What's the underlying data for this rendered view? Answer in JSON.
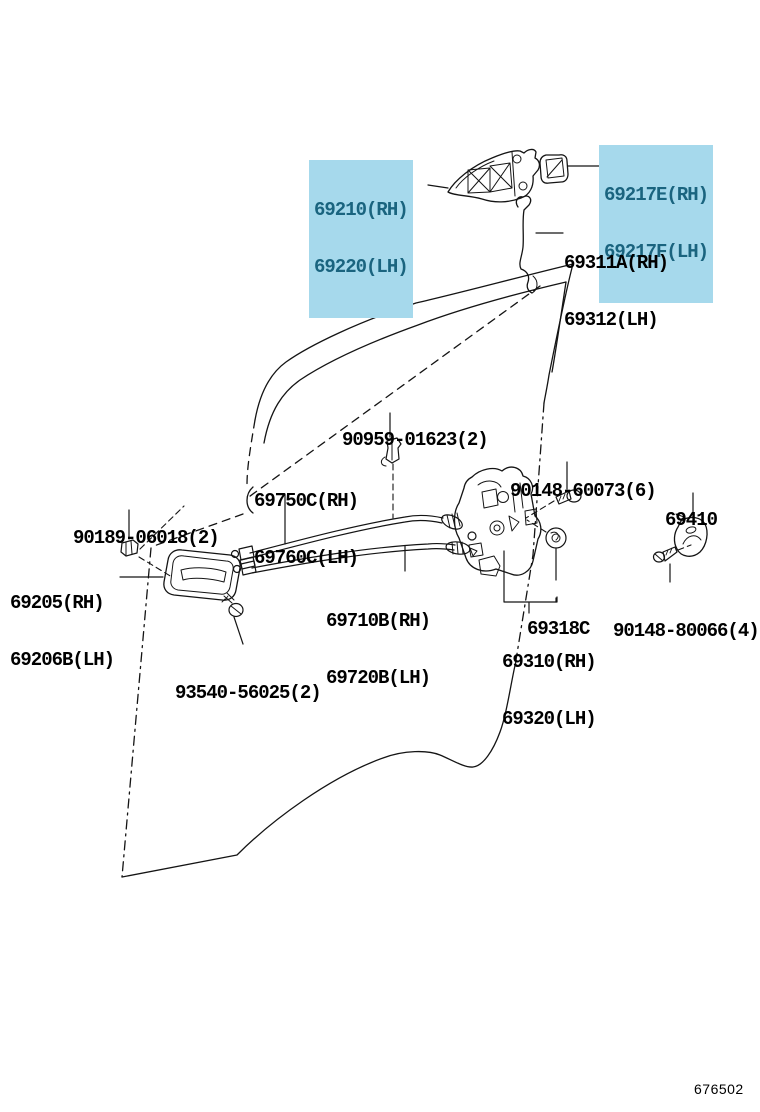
{
  "diagram": {
    "code": "676502",
    "highlight_bg": "#a6d9ec",
    "highlight_fg": "#1a647f",
    "line_color": "#141414"
  },
  "labels": [
    {
      "id": "69210-69220",
      "highlighted": true,
      "lines": [
        "69210(RH)",
        "69220(LH)"
      ]
    },
    {
      "id": "69217E-69217F",
      "highlighted": true,
      "lines": [
        "69217E(RH)",
        "69217F(LH)"
      ]
    },
    {
      "id": "69311A-69312",
      "highlighted": false,
      "lines": [
        "69311A(RH)",
        "69312(LH)"
      ]
    },
    {
      "id": "90959-01623",
      "highlighted": false,
      "lines": [
        "90959-01623(2)"
      ]
    },
    {
      "id": "69750C-69760C",
      "highlighted": false,
      "lines": [
        "69750C(RH)",
        "69760C(LH)"
      ]
    },
    {
      "id": "90148-60073",
      "highlighted": false,
      "lines": [
        "90148-60073(6)"
      ]
    },
    {
      "id": "69410",
      "highlighted": false,
      "lines": [
        "69410"
      ]
    },
    {
      "id": "90189-06018",
      "highlighted": false,
      "lines": [
        "90189-06018(2)"
      ]
    },
    {
      "id": "69205-69206B",
      "highlighted": false,
      "lines": [
        "69205(RH)",
        "69206B(LH)"
      ]
    },
    {
      "id": "69710B-69720B",
      "highlighted": false,
      "lines": [
        "69710B(RH)",
        "69720B(LH)"
      ]
    },
    {
      "id": "69318C",
      "highlighted": false,
      "lines": [
        "69318C"
      ]
    },
    {
      "id": "90148-80066",
      "highlighted": false,
      "lines": [
        "90148-80066(4)"
      ]
    },
    {
      "id": "69310-69320",
      "highlighted": false,
      "lines": [
        "69310(RH)",
        "69320(LH)"
      ]
    },
    {
      "id": "93540-56025",
      "highlighted": false,
      "lines": [
        "93540-56025(2)"
      ]
    }
  ]
}
